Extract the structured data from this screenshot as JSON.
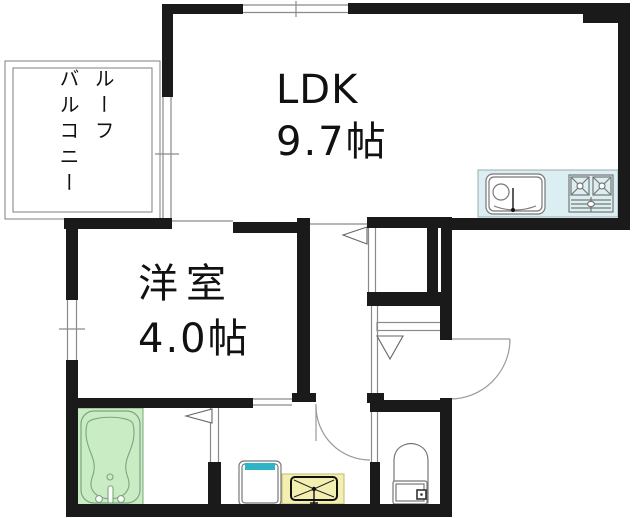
{
  "rooms": {
    "ldk": {
      "name": "LDK",
      "size": "9.7帖"
    },
    "western_room": {
      "name": "洋室",
      "size": "4.0帖"
    },
    "balcony": {
      "line1": "ルーフ",
      "line2": "バルコニー",
      "full_name": "ルーフバルコニー"
    }
  },
  "fixtures": {
    "kitchen_counter": "kitchen-counter",
    "kitchen_sink": "kitchen-sink-icon",
    "gas_stove": "gas-stove-icon",
    "bathtub": "bathtub-icon",
    "washing_machine_pan": "washing-machine-pan-icon",
    "washbasin": "washbasin-icon",
    "toilet": "toilet-icon",
    "entrance_door": "entrance-door-arc",
    "washroom_door": "washroom-door-arc",
    "sliding_door_markers": "sliding-door-triangle"
  },
  "colors": {
    "wall": "#1a1a1a",
    "line": "#8a8a8a",
    "fixture_line": "#777777",
    "arc": "#9a9a9a",
    "counter_fill": "#dbeef1",
    "counter_border": "#9aabb0",
    "tub_fill": "#c9ecc5",
    "tub_line": "#7da57d",
    "vanity_fill": "#f3efb0",
    "vanity_border": "#c2ba70",
    "washer_accent": "#2fb3c6",
    "text": "#111111",
    "bg": "#ffffff"
  }
}
